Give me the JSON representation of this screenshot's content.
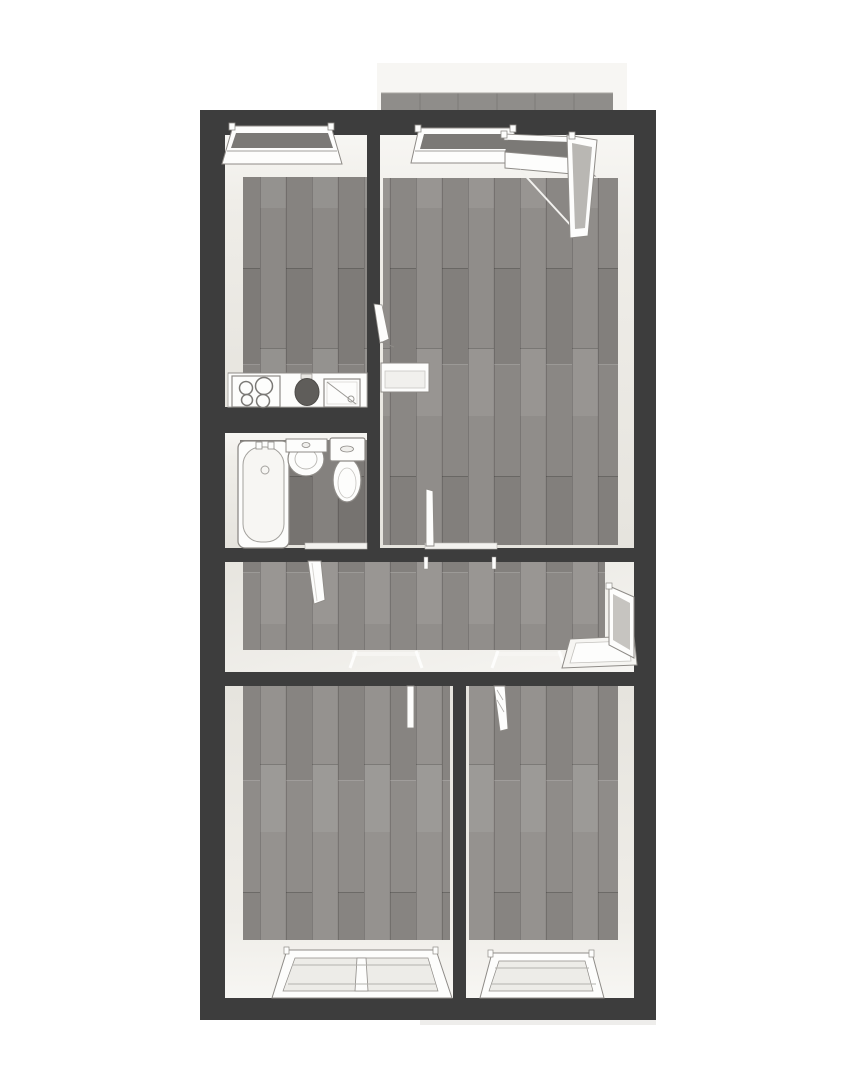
{
  "page": {
    "type": "floor-plan-render",
    "view": "top-down-3d",
    "background": "#ffffff"
  },
  "colors": {
    "wall": "#3d3d3d",
    "wall_face_light": "#f7f6f3",
    "wall_face_shade": "#e6e4de",
    "floor_kitchen": "#868380",
    "floor_living": "#8a8784",
    "floor_bathroom": "#7d7a77",
    "floor_hallway": "#8b8885",
    "floor_bedroom": "#8f8c89",
    "balcony_floor": "#f7f6f3",
    "balcony_tile": "#8f8d8a",
    "fixture_white": "#fdfdfc",
    "outline": "#8e8b87",
    "glass_dark": "#7b7976",
    "glass_light": "#edece8",
    "door_glass": "#c6c4c0",
    "basin_dark": "#5f5d5a"
  },
  "plan": {
    "balcony": {
      "id": "balcony",
      "tile_count": 6
    },
    "rooms": [
      {
        "id": "kitchen",
        "fixtures": [
          "window",
          "counter",
          "stove",
          "sink-basin",
          "sink-drainer"
        ]
      },
      {
        "id": "living-room",
        "fixtures": [
          "window",
          "open-balcony-door",
          "open-door-to-hallway",
          "open-door-to-kitchen"
        ]
      },
      {
        "id": "bathroom",
        "fixtures": [
          "bathtub",
          "washbasin",
          "toilet",
          "open-door-to-hallway"
        ]
      },
      {
        "id": "hallway",
        "fixtures": [
          "open-entrance-door",
          "entrance-step",
          "door-threshold-left",
          "door-threshold-right"
        ]
      },
      {
        "id": "bedroom-left",
        "fixtures": [
          "double-window",
          "open-door"
        ]
      },
      {
        "id": "bedroom-right",
        "fixtures": [
          "window",
          "open-door"
        ]
      }
    ],
    "windows_total": 5,
    "doors_total": 7
  }
}
